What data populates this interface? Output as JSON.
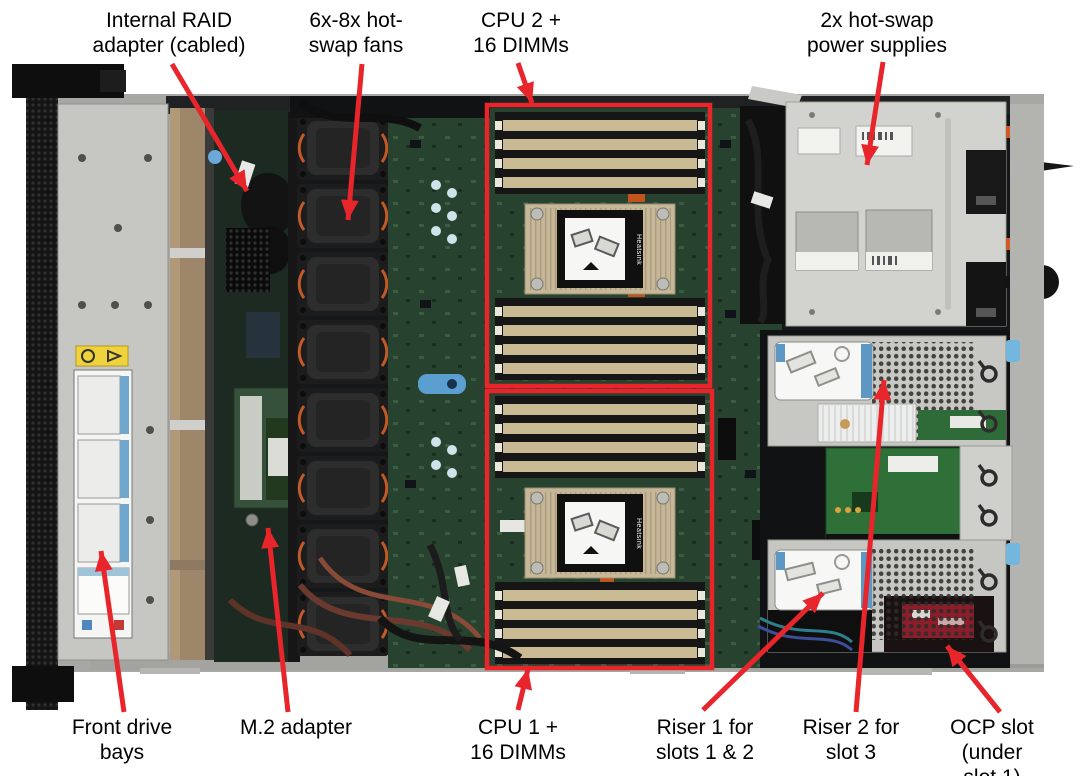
{
  "diagram": {
    "type": "annotated hardware photo",
    "subject": "Top view of 1U rack server internal components with callout labels",
    "accent_color": "#e8252a",
    "heatsink_label": "Heatsink",
    "palette": {
      "chassis_grey": "#c7c8c3",
      "pcb_green": "#27422e",
      "heatsink_tan": "#c6b798",
      "dimm_gold": "#c9ba94",
      "fan_black": "#1c1c1c",
      "psu_grey": "#d2d3ce",
      "ocp_board_red": "#8c1e2c",
      "label_text": "#000000"
    },
    "highlight_boxes": [
      {
        "x": 487,
        "y": 105,
        "w": 223,
        "h": 281
      },
      {
        "x": 487,
        "y": 391,
        "w": 225,
        "h": 277
      }
    ],
    "callouts": [
      {
        "id": "internal-raid-adapter",
        "label": "Internal RAID\nadapter (cabled)",
        "position": "top",
        "label_cx": 169,
        "label_top": 8,
        "arrow": {
          "x1": 172,
          "y1": 64,
          "x2": 247,
          "y2": 191
        }
      },
      {
        "id": "hot-swap-fans",
        "label": "6x-8x hot-\nswap fans",
        "position": "top",
        "label_cx": 356,
        "label_top": 8,
        "arrow": {
          "x1": 362,
          "y1": 64,
          "x2": 348,
          "y2": 220
        }
      },
      {
        "id": "cpu2-16dimms",
        "label": "CPU 2 +\n16 DIMMs",
        "position": "top",
        "label_cx": 521,
        "label_top": 8,
        "arrow": {
          "x1": 518,
          "y1": 63,
          "x2": 532,
          "y2": 103
        }
      },
      {
        "id": "power-supplies",
        "label": "2x hot-swap\npower supplies",
        "position": "top",
        "label_cx": 877,
        "label_top": 8,
        "arrow": {
          "x1": 883,
          "y1": 62,
          "x2": 867,
          "y2": 165
        }
      },
      {
        "id": "front-drive-bays",
        "label": "Front drive\nbays",
        "position": "bottom",
        "label_cx": 122,
        "label_top": 715,
        "arrow": {
          "x1": 124,
          "y1": 712,
          "x2": 101,
          "y2": 551
        }
      },
      {
        "id": "m2-adapter",
        "label": "M.2 adapter",
        "position": "bottom",
        "label_cx": 296,
        "label_top": 715,
        "arrow": {
          "x1": 288,
          "y1": 712,
          "x2": 268,
          "y2": 528
        }
      },
      {
        "id": "cpu1-16dimms",
        "label": "CPU 1 +\n16 DIMMs",
        "position": "bottom",
        "label_cx": 518,
        "label_top": 715,
        "arrow": {
          "x1": 518,
          "y1": 710,
          "x2": 528,
          "y2": 669
        }
      },
      {
        "id": "riser1-slots-1-2",
        "label": "Riser 1 for\nslots 1 & 2",
        "position": "bottom",
        "label_cx": 705,
        "label_top": 715,
        "arrow": {
          "x1": 703,
          "y1": 710,
          "x2": 823,
          "y2": 593
        }
      },
      {
        "id": "riser2-slot-3",
        "label": "Riser 2 for\nslot 3",
        "position": "bottom",
        "label_cx": 851,
        "label_top": 715,
        "arrow": {
          "x1": 856,
          "y1": 712,
          "x2": 884,
          "y2": 380
        }
      },
      {
        "id": "ocp-slot",
        "label": "OCP slot\n(under slot 1)",
        "position": "bottom",
        "label_cx": 992,
        "label_top": 715,
        "arrow": {
          "x1": 1000,
          "y1": 712,
          "x2": 947,
          "y2": 646
        }
      }
    ]
  }
}
